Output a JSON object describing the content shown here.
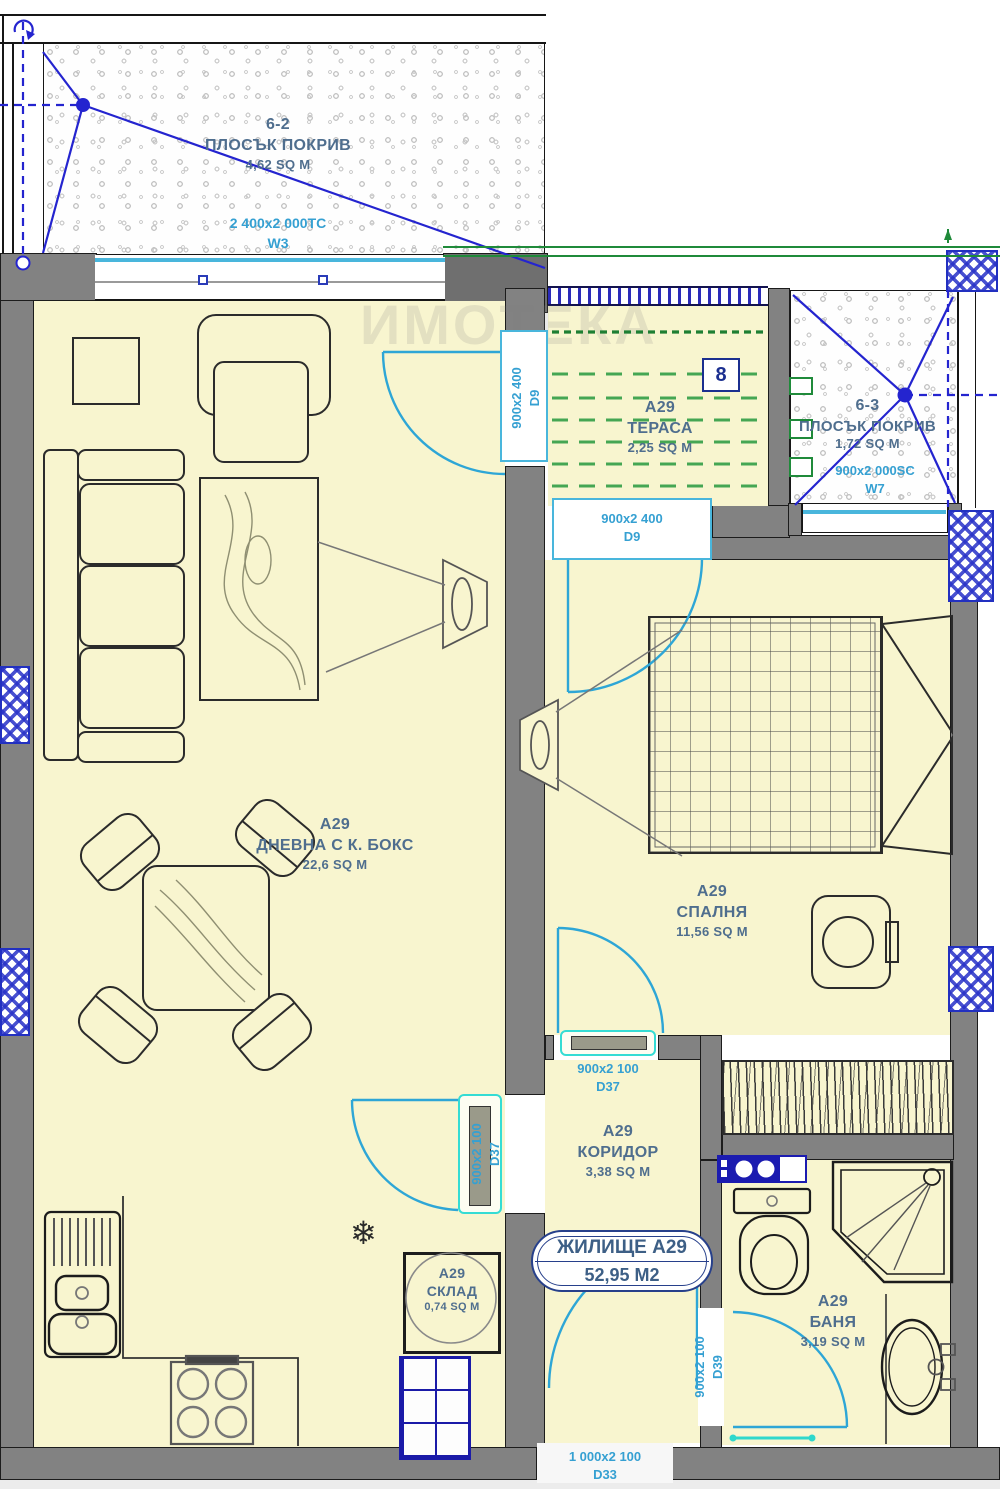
{
  "watermark": "ИМОТЕКА",
  "rooms": {
    "roof_left": {
      "code": "6-2",
      "name": "ПЛОСЪК ПОКРИВ",
      "area": "4,62 SQ M"
    },
    "roof_right": {
      "code": "6-3",
      "name": "ПЛОСЪК ПОКРИВ",
      "area": "1,72 SQ M"
    },
    "terrace": {
      "apt": "А29",
      "name": "ТЕРАСА",
      "area": "2,25 SQ M"
    },
    "living": {
      "apt": "А29",
      "name": "ДНЕВНА С К. БОКС",
      "area": "22,6 SQ M"
    },
    "bedroom": {
      "apt": "А29",
      "name": "СПАЛНЯ",
      "area": "11,56 SQ M"
    },
    "corridor": {
      "apt": "А29",
      "name": "КОРИДОР",
      "area": "3,38 SQ M"
    },
    "storage": {
      "apt": "А29",
      "name": "СКЛАД",
      "area": "0,74 SQ M"
    },
    "bath": {
      "apt": "А29",
      "name": "БАНЯ",
      "area": "3,19 SQ M"
    }
  },
  "windows": {
    "w3": {
      "size": "2 400x2 000ТС",
      "code": "W3"
    },
    "w7": {
      "size": "900x2 000SC",
      "code": "W7"
    }
  },
  "doors": {
    "d9_living_terrace": {
      "size": "900x2 400",
      "code": "D9"
    },
    "d9_terrace_bedroom": {
      "size": "900x2 400",
      "code": "D9"
    },
    "d37_corridor_bedroom": {
      "size": "900x2 100",
      "code": "D37"
    },
    "d37_corridor_living": {
      "size": "900x2 100",
      "code": "D37"
    },
    "d39_bath": {
      "size": "900x2 100",
      "code": "D39"
    },
    "d33_entry": {
      "size": "1 000x2 100",
      "code": "D33"
    }
  },
  "apartment_tag": {
    "title": "ЖИЛИЩЕ А29",
    "area": "52,95 М2"
  },
  "markers": {
    "node": "8",
    "snowflake": "❄"
  },
  "colors": {
    "roof_line_blue": "#2424cf",
    "door_cyan": "#2ea6d6",
    "lintel_turquoise": "#35dcd4",
    "green": "#1f8a3a",
    "wall_gray": "#828282",
    "room_fill": "#f8f5cf",
    "label_blue": "#4f6e8e",
    "navy": "#27408b"
  }
}
